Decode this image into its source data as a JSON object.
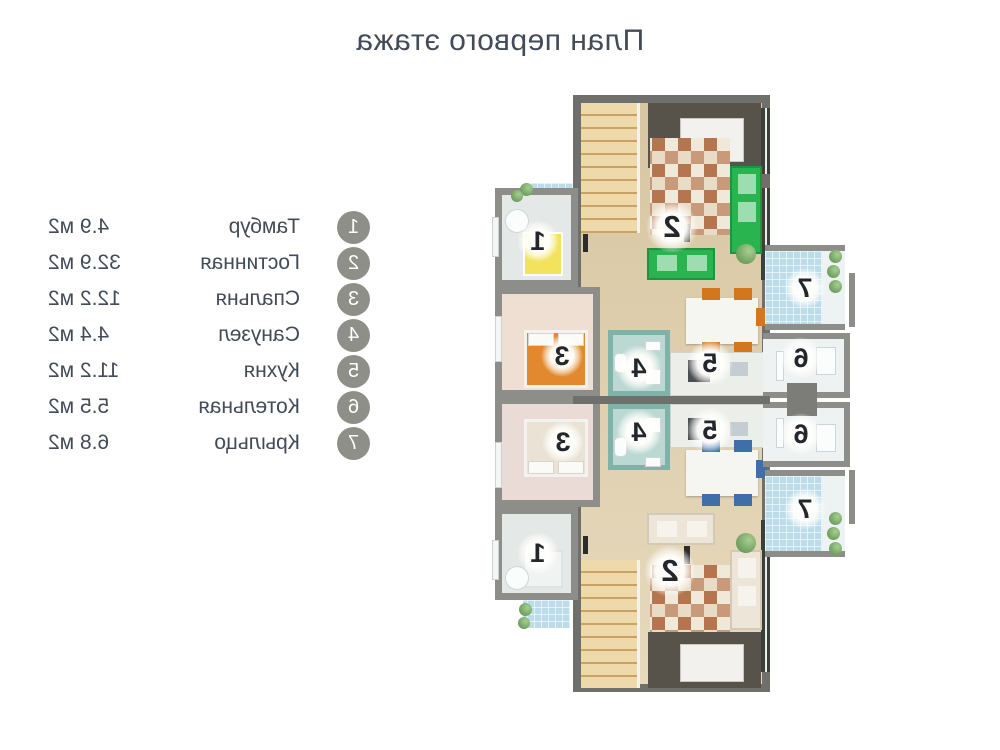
{
  "title": "План первого этажа",
  "legend": {
    "items": [
      {
        "number": "1",
        "label": "Тамбур",
        "area": "4.9 м2"
      },
      {
        "number": "2",
        "label": "Гостинная",
        "area": "32.9 м2"
      },
      {
        "number": "3",
        "label": "Спальня",
        "area": "12.2 м2"
      },
      {
        "number": "4",
        "label": "Санузел",
        "area": "4.4 м2"
      },
      {
        "number": "5",
        "label": "Кухня",
        "area": "11.2 м2"
      },
      {
        "number": "6",
        "label": "Котельная",
        "area": "5.5 м2"
      },
      {
        "number": "7",
        "label": "Крыльцо",
        "area": "6.8 м2"
      }
    ]
  },
  "plan": {
    "markers": [
      {
        "room": "tambour-top",
        "number": "1"
      },
      {
        "room": "living-top",
        "number": "2"
      },
      {
        "room": "bedroom-top",
        "number": "3"
      },
      {
        "room": "bathroom-top",
        "number": "4"
      },
      {
        "room": "kitchen-top",
        "number": "5"
      },
      {
        "room": "boiler-top",
        "number": "6"
      },
      {
        "room": "porch-top",
        "number": "7"
      },
      {
        "room": "tambour-bottom",
        "number": "1"
      },
      {
        "room": "living-bottom",
        "number": "2"
      },
      {
        "room": "bedroom-bottom",
        "number": "3"
      },
      {
        "room": "bathroom-bottom",
        "number": "4"
      },
      {
        "room": "kitchen-bottom",
        "number": "5"
      },
      {
        "room": "boiler-bottom",
        "number": "6"
      },
      {
        "room": "porch-bottom",
        "number": "7"
      }
    ]
  },
  "colors": {
    "text": "#434b57",
    "legend_circle": "#8f8f8a",
    "wall_dark": "#6f6f6b",
    "wall_light": "#8d8d89",
    "floor_wood_a": "#d8c6a2",
    "floor_wood_b": "#e6d9bc",
    "dark_area": "#57534a",
    "stairs_a": "#eed9ab",
    "stairs_b": "#c9a265",
    "rug_a": "#b5754e",
    "rug_b": "#e8dcc6",
    "rug_c": "#c89a79",
    "rug_d": "#f0e8d9",
    "sofa_green": "#29b44f",
    "sofa_cream": "#ece5d8",
    "bed_orange": "#e2892f",
    "bed_cream": "#e9e2d5",
    "bath_wall": "#7fb2a9",
    "bath_floor": "#bcd8d2",
    "porch_tile": "#bcdcea",
    "chair_orange": "#d2771e",
    "chair_blue": "#3f6fa8",
    "wardrobe_yellow": "#f3e25e",
    "boiler_floor": "#eef2f3",
    "bedroom_floor_a": "#eedfd2",
    "bedroom_floor_b": "#eadbd6",
    "tambour_floor": "#e4e8e6",
    "window_dark": "#39413a",
    "plant": "#6f9f5f",
    "marker_text": "#23272c"
  }
}
